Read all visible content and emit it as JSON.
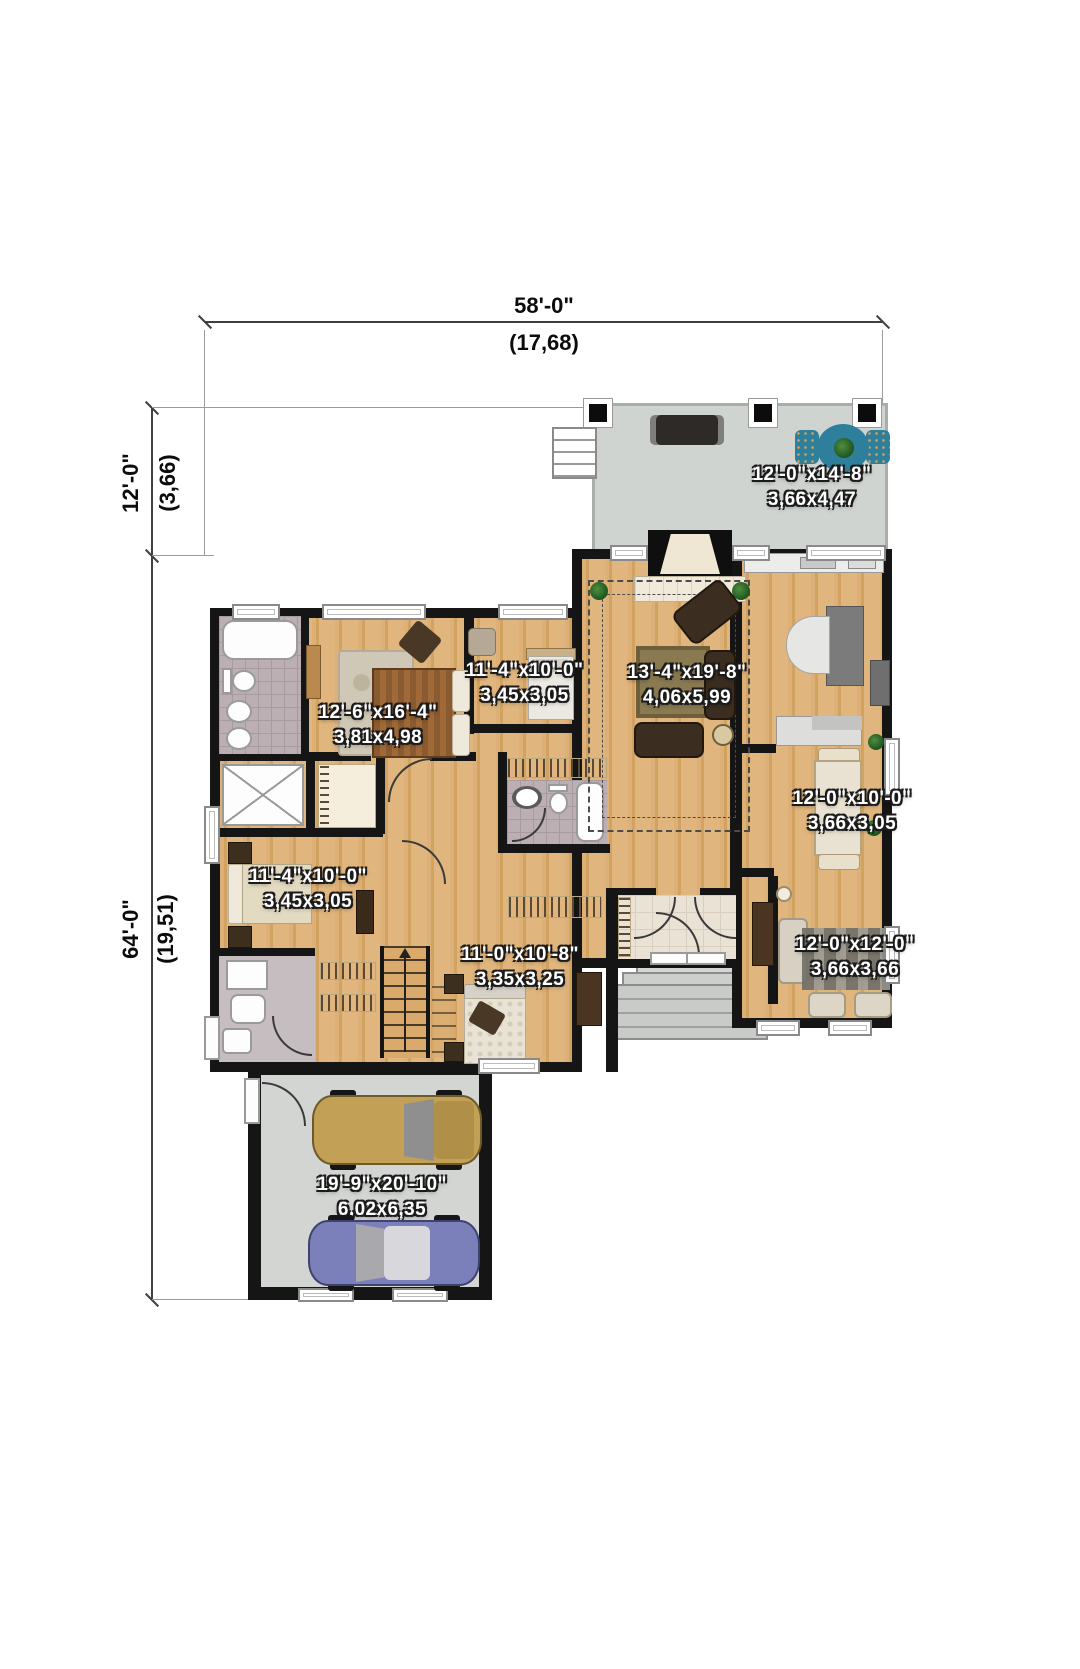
{
  "plan": {
    "title": "house-floor-plan",
    "dims": {
      "width_ft": "58'-0\"",
      "width_m": "(17,68)",
      "terrace_depth_ft": "12'-0\"",
      "terrace_depth_m": "(3,66)",
      "height_ft": "64'-0\"",
      "height_m": "(19,51)"
    },
    "rooms": [
      {
        "id": "terrace",
        "size_ft": "12'-0\"x14'-8\"",
        "size_m": "3,66x4,47"
      },
      {
        "id": "master-bedroom",
        "size_ft": "12'-6\"x16'-4\"",
        "size_m": "3,81x4,98"
      },
      {
        "id": "bedroom-2",
        "size_ft": "11'-4\"x10'-0\"",
        "size_m": "3,45x3,05"
      },
      {
        "id": "living-room",
        "size_ft": "13'-4\"x19'-8\"",
        "size_m": "4,06x5,99"
      },
      {
        "id": "dining-room",
        "size_ft": "12'-0\"x10'-0\"",
        "size_m": "3,66x3,05"
      },
      {
        "id": "family-room",
        "size_ft": "12'-0\"x12'-0\"",
        "size_m": "3,66x3,66"
      },
      {
        "id": "bedroom-3",
        "size_ft": "11'-4\"x10'-0\"",
        "size_m": "3,45x3,05"
      },
      {
        "id": "bedroom-4",
        "size_ft": "11'-0\"x10'-8\"",
        "size_m": "3,35x3,25"
      },
      {
        "id": "garage",
        "size_ft": "19'-9\"x20'-10\"",
        "size_m": "6,02x6,35"
      }
    ],
    "colors": {
      "wood": "#d9aa6b",
      "wall": "#151515",
      "terrace_floor": "#d0d4d1",
      "garage_floor": "#d2d5d2",
      "bath_tile": "#bbafb4",
      "entry_tile": "#eae3d5",
      "patio_table": "#2e7f9b",
      "car_gold": "#c2a055",
      "car_blue": "#7b80bb"
    }
  }
}
